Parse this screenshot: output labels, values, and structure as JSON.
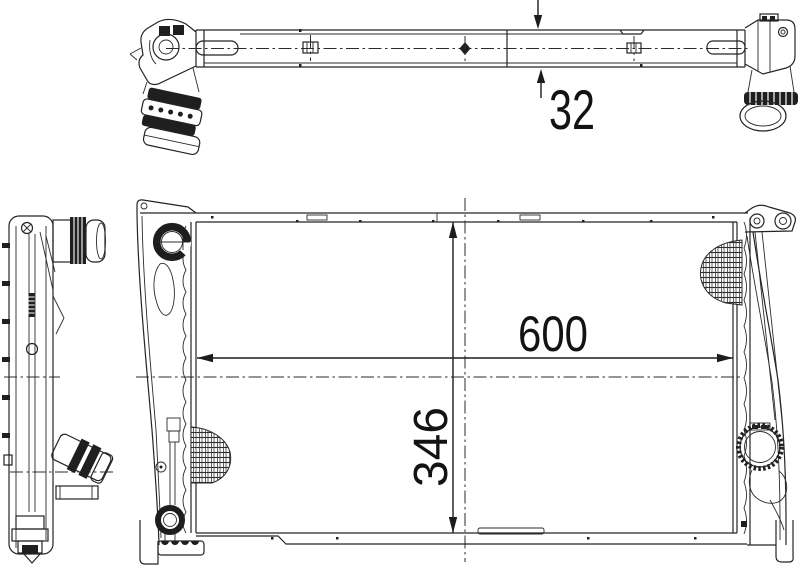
{
  "page": {
    "background": "#ffffff",
    "line_color": "#242424"
  },
  "annotations": {
    "depth": "32",
    "width": "600",
    "height": "346"
  }
}
